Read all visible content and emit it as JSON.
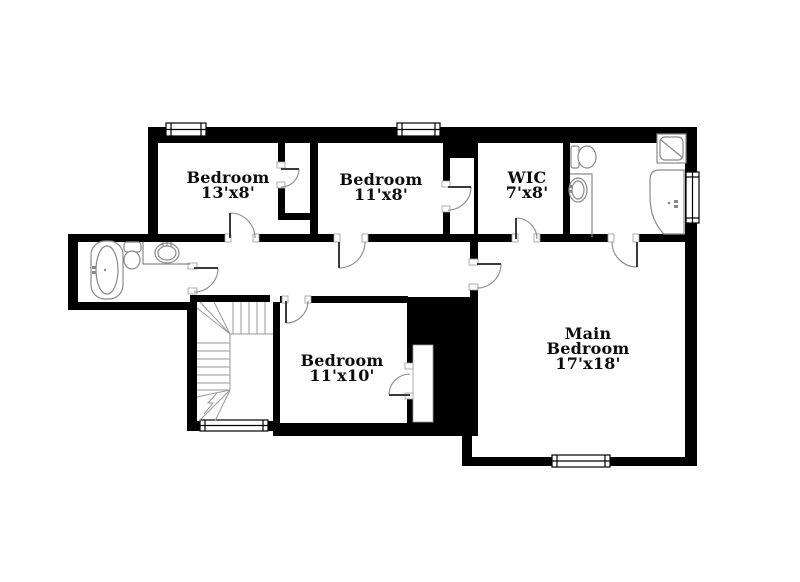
{
  "floor_plan": {
    "title": "Second floor plan",
    "background_color": "#ffffff",
    "wall_color": "#000000",
    "fixture_line_color": "#8a8a8a",
    "stair_line_color": "#9a9a9a",
    "text_color": "#0c0c0c",
    "rooms": [
      {
        "id": "bedroom-1",
        "name": "Bedroom",
        "dimensions": "13'x8'"
      },
      {
        "id": "bedroom-2",
        "name": "Bedroom",
        "dimensions": "11'x8'"
      },
      {
        "id": "wic",
        "name": "WIC",
        "dimensions": "7'x8'"
      },
      {
        "id": "bedroom-3",
        "name": "Bedroom",
        "dimensions": "11'x10'"
      },
      {
        "id": "main-bedroom",
        "name": "Main Bedroom",
        "dimensions": "17'x18'"
      }
    ],
    "fixtures": [
      "bathtub",
      "toilet",
      "sink-vanity",
      "staircase",
      "toilet",
      "sink-vanity",
      "shower",
      "corner-tub"
    ],
    "window_count": 5,
    "door_count": 10
  }
}
